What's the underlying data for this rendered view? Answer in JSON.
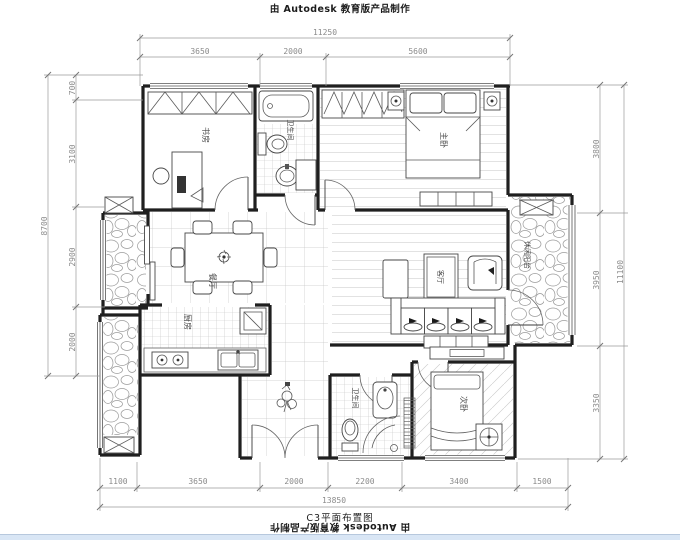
{
  "watermark": {
    "top": "由 Autodesk 教育版产品制作",
    "bottom": "由 Autodesk 教育版产品制作"
  },
  "title": "C3平面布置图",
  "dimensions": {
    "top": {
      "total": "11250",
      "segments": [
        "3650",
        "2000",
        "5600"
      ]
    },
    "left": {
      "total": "8700",
      "segments": [
        "700",
        "3100",
        "2900",
        "2000"
      ]
    },
    "right": {
      "total": "11100",
      "segments": [
        "3800",
        "3950",
        "3350"
      ]
    },
    "bottom": {
      "total": "13850",
      "segments": [
        "1100",
        "3650",
        "2000",
        "2200",
        "3400",
        "1500"
      ]
    }
  },
  "rooms": {
    "study": "书房",
    "bathroom1": "卫生间",
    "master_bedroom": "主卧",
    "dining": "餐厅",
    "kitchen": "厨房",
    "living": "客厅",
    "leisure_balcony": "休闲阳台",
    "bathroom2": "卫生间",
    "second_bedroom": "次卧"
  },
  "colors": {
    "line": "#1f1f1f",
    "dimension": "#8b8b8b",
    "background": "#ffffff"
  }
}
